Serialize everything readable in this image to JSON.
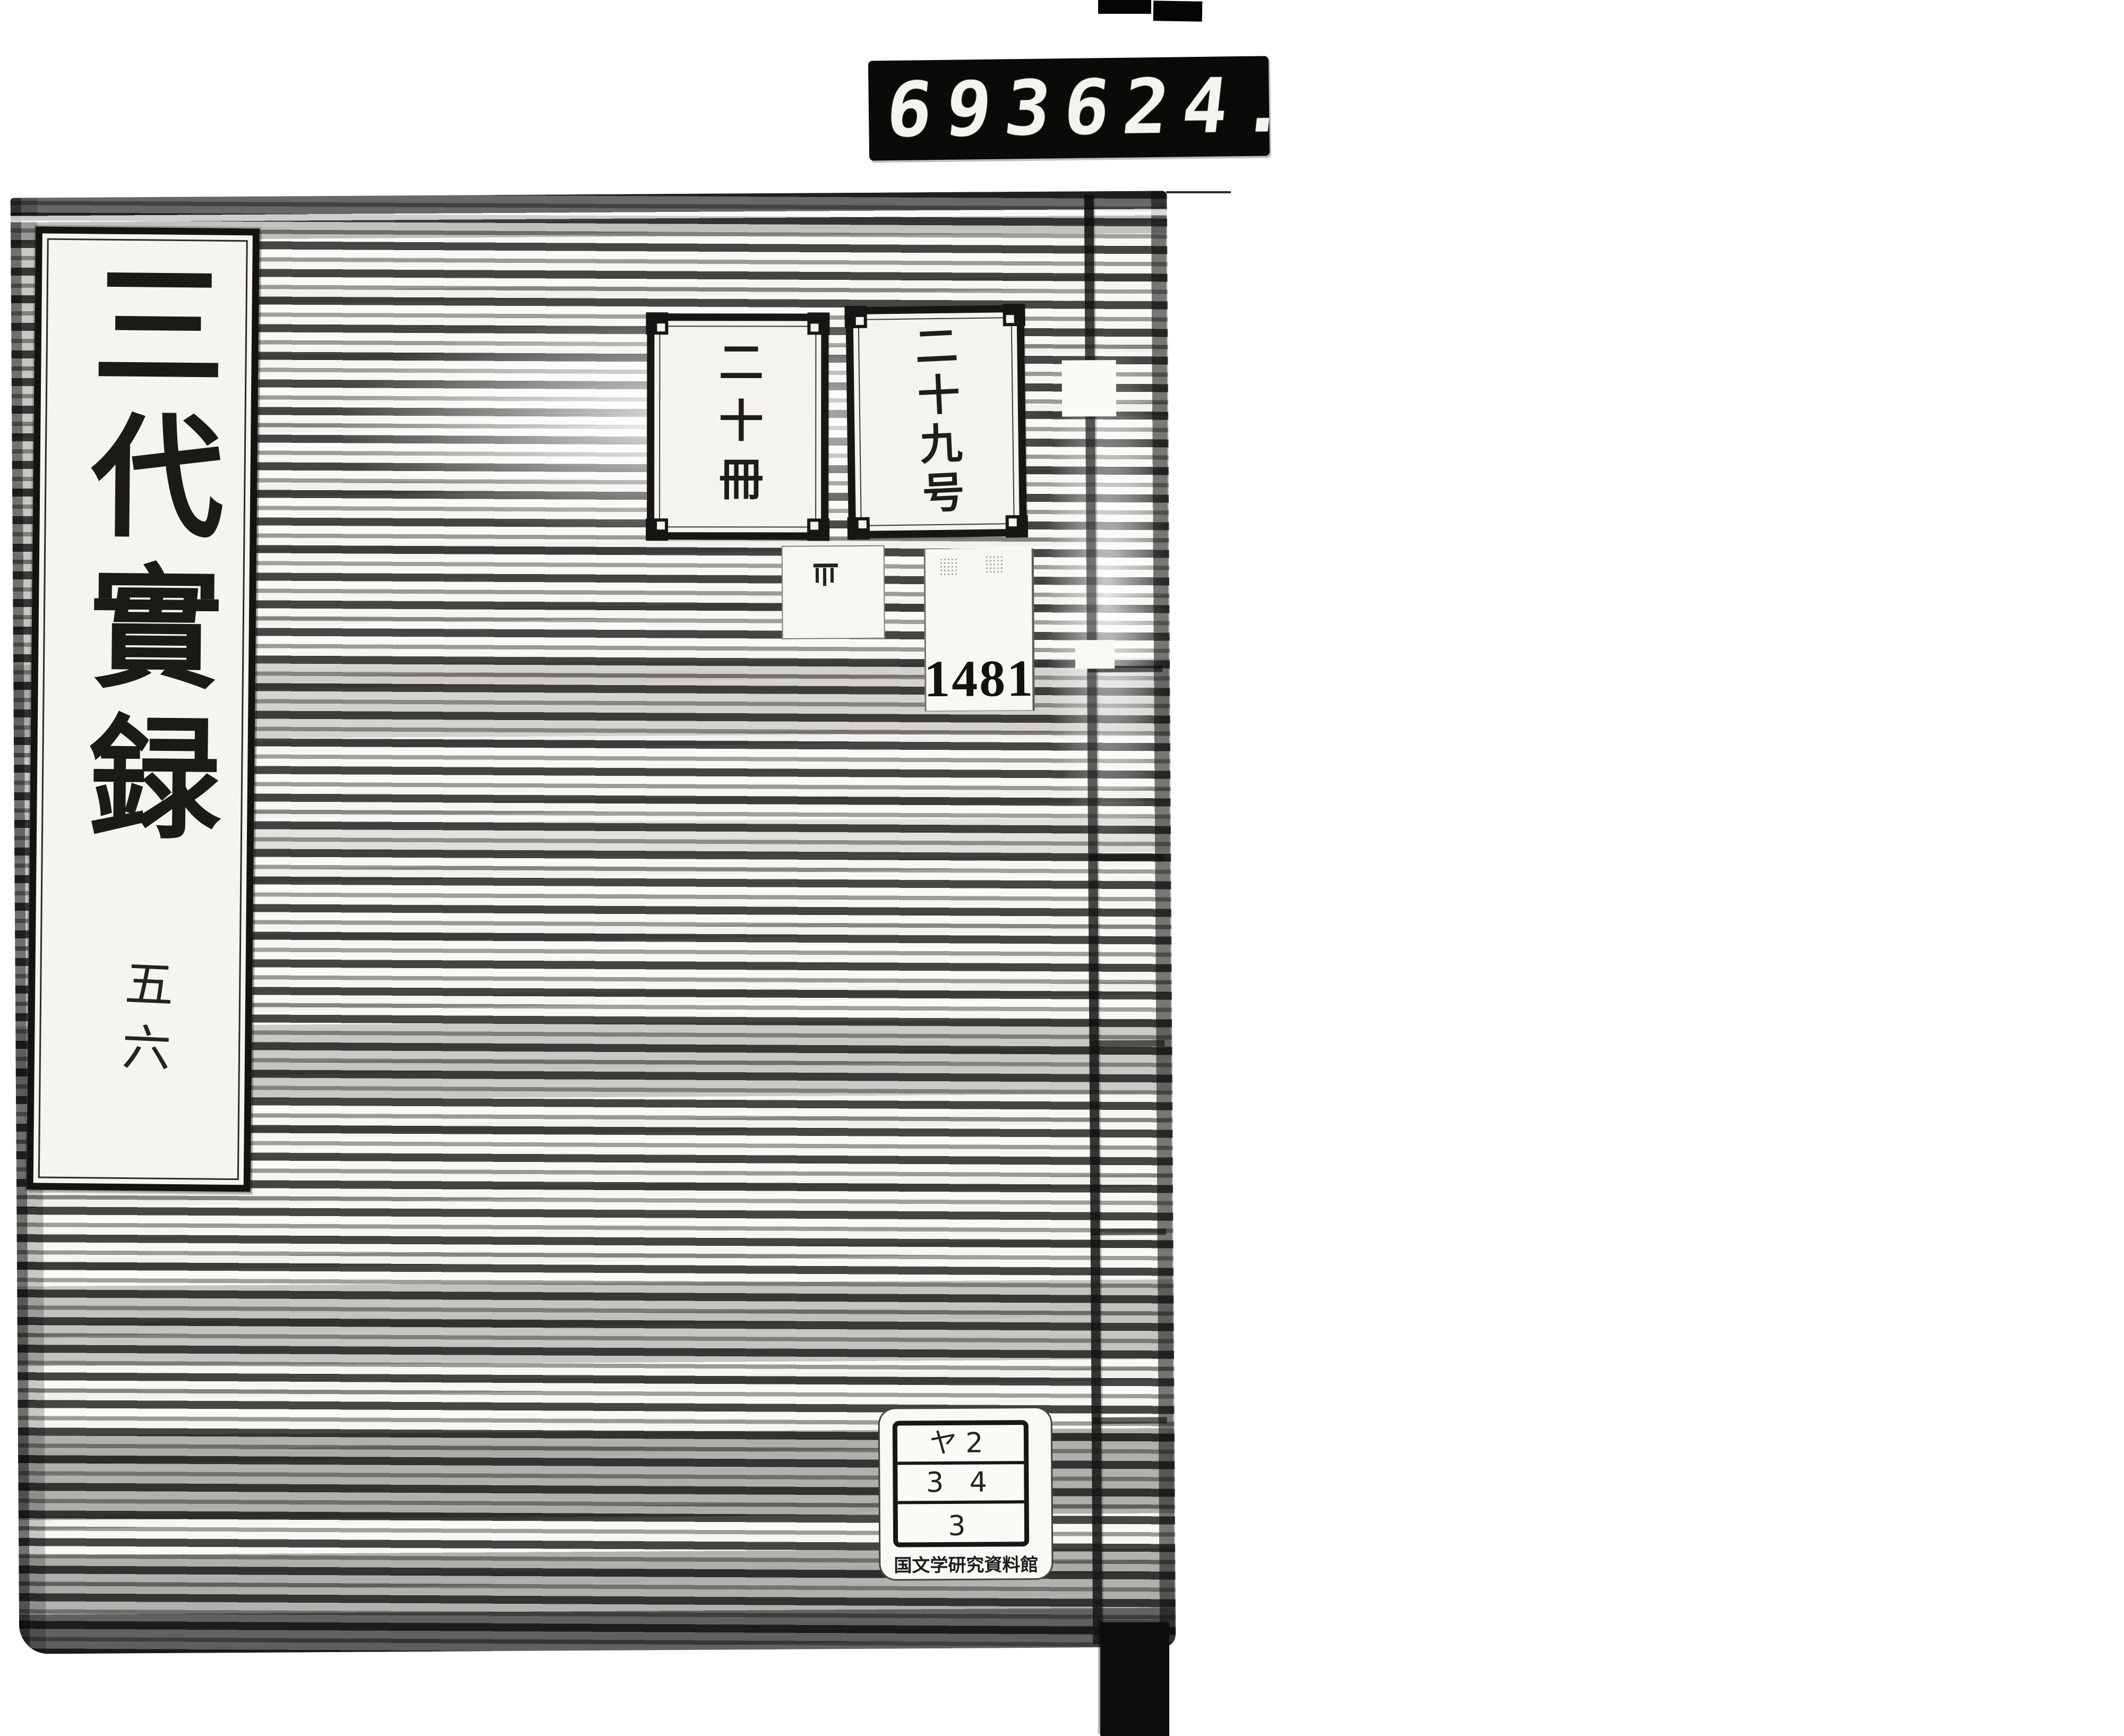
{
  "counter": {
    "left": "693",
    "right": "624."
  },
  "cover": {
    "title_slip": {
      "title": "三代實録",
      "volume": "五六"
    },
    "count_label": "二十冊",
    "number_label": "二十九号",
    "accession_number": "1481",
    "call_label": {
      "row1": "ヤ2",
      "row2": "3 4",
      "row3": "3",
      "institution": "国文学研究資料館"
    }
  },
  "colors": {
    "ink": "#1b1a17",
    "paper_slip": "#f6f4ee",
    "display_background": "#0a0a09",
    "display_digits": "#f4f4ef"
  }
}
